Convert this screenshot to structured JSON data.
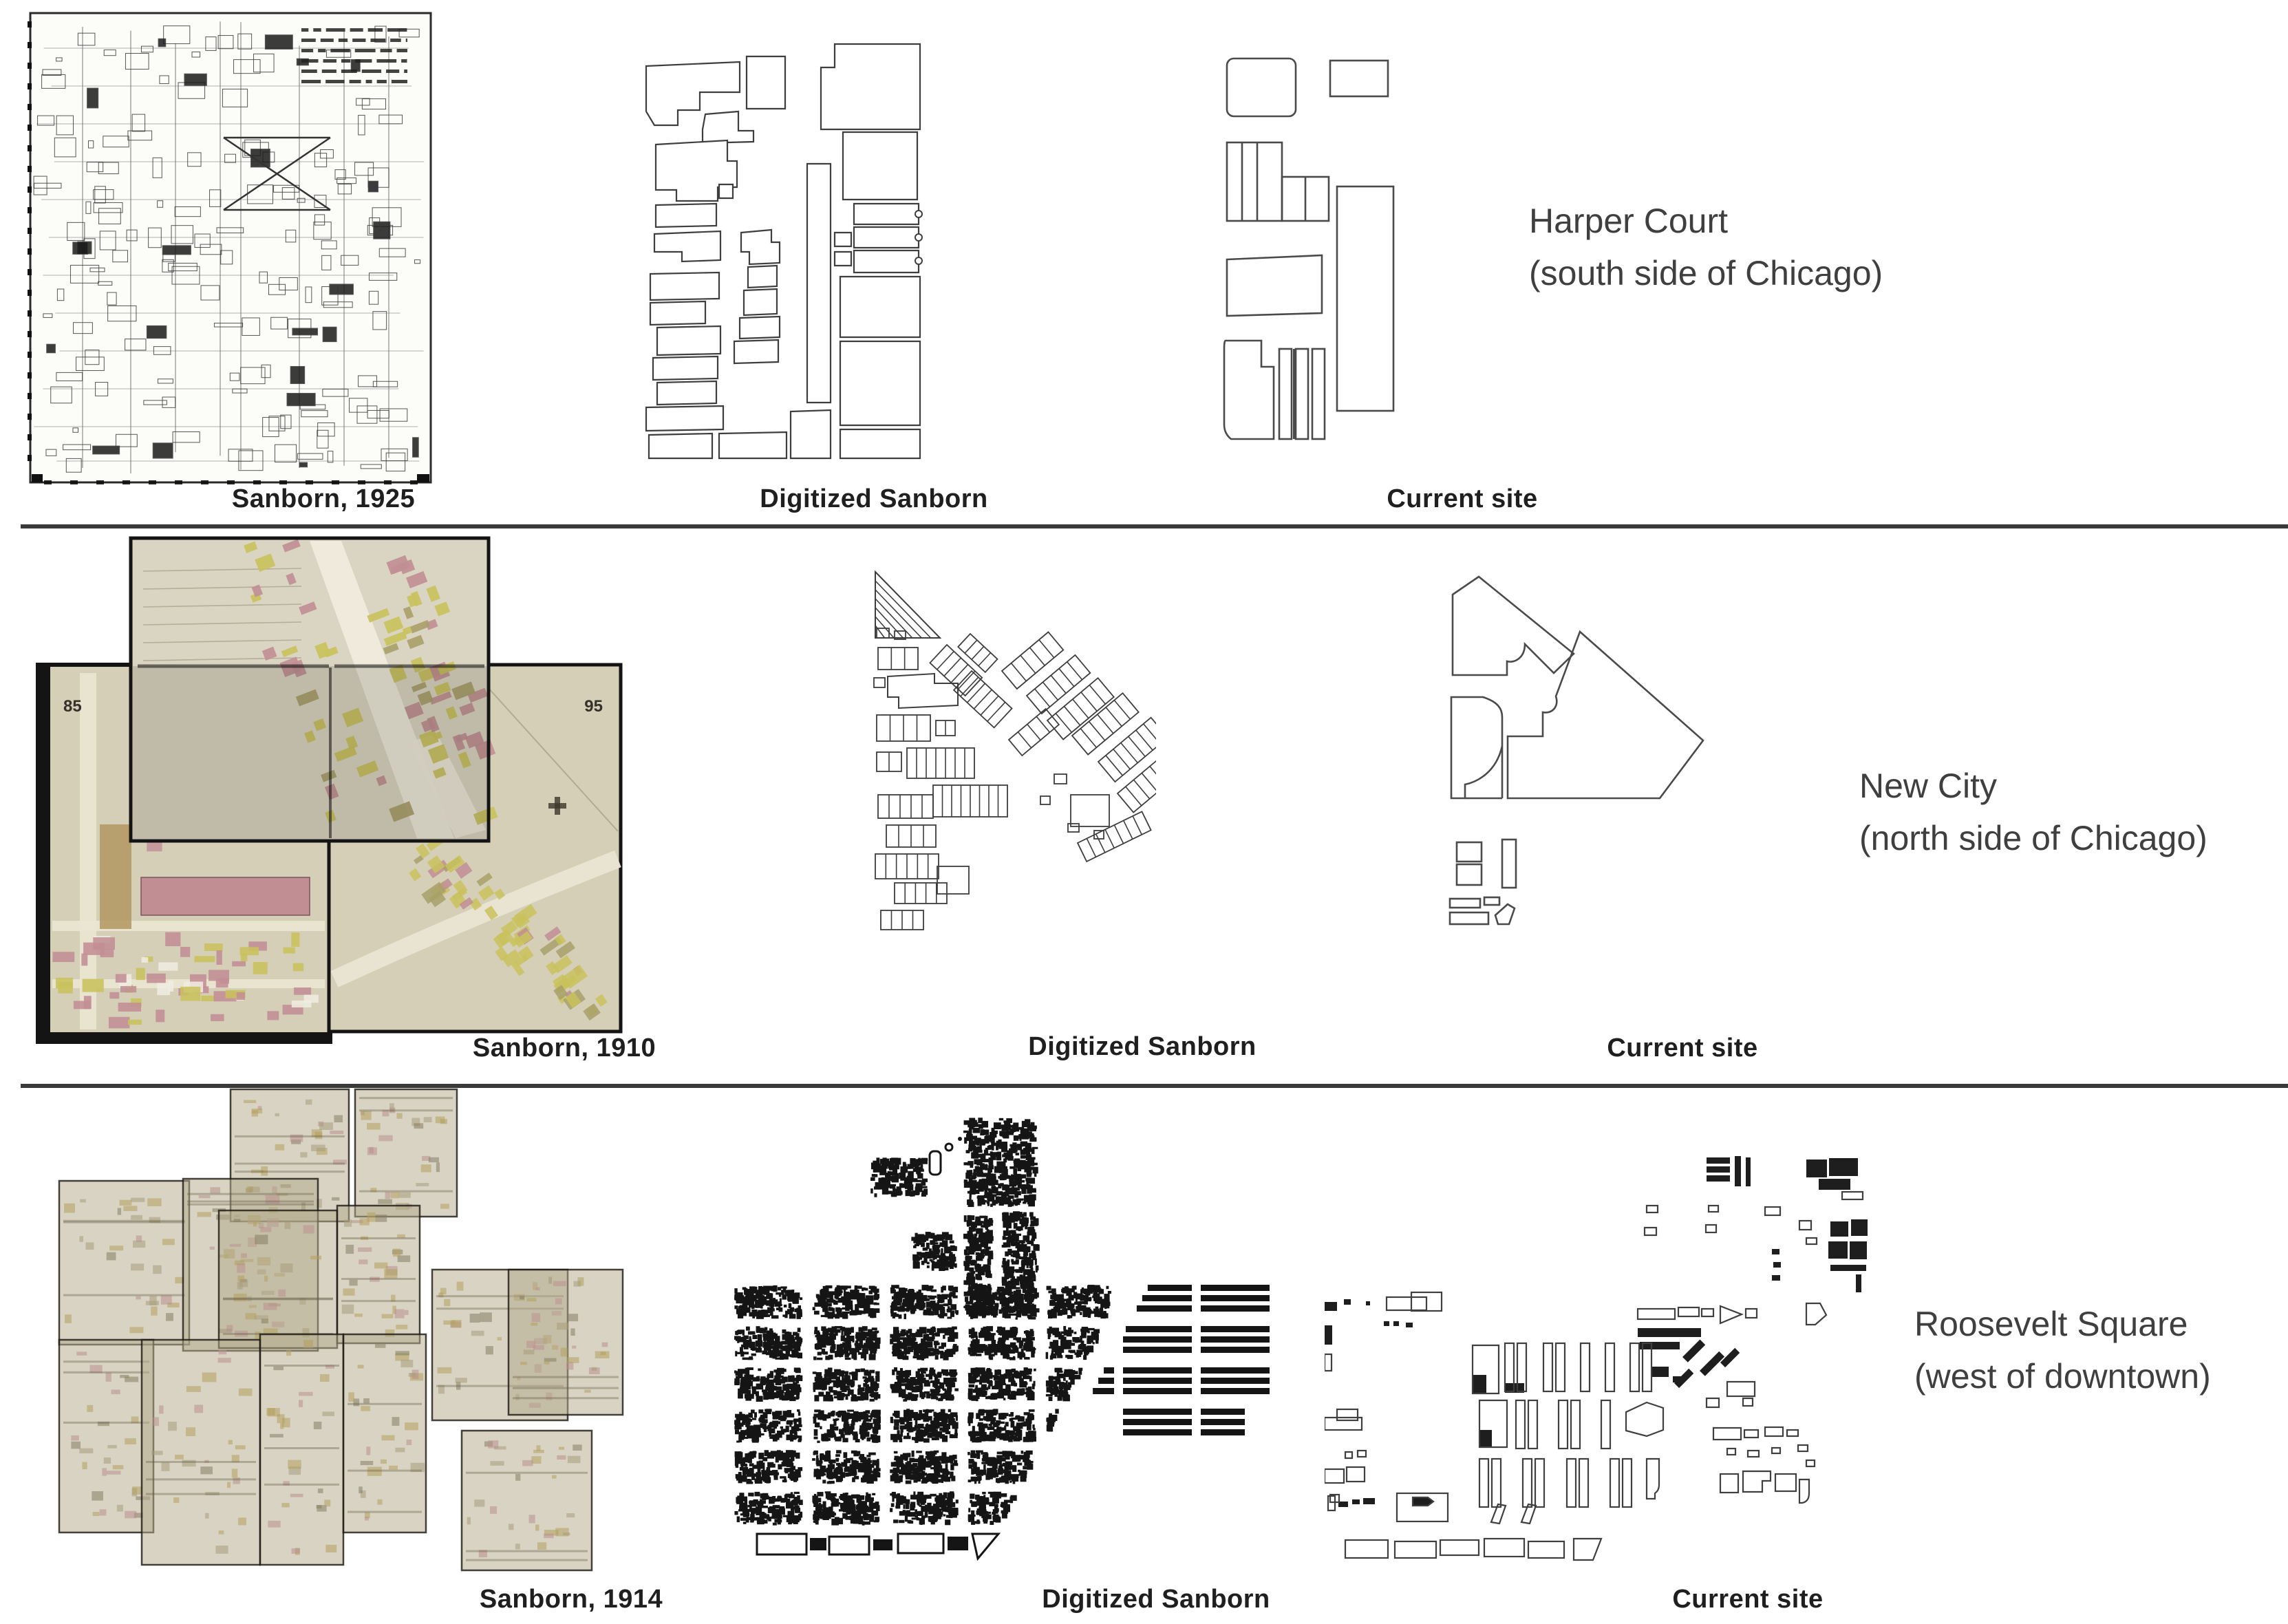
{
  "figure": {
    "type": "map-comparison-figure",
    "rows": [
      {
        "id": "harper-court",
        "panels": [
          {
            "caption": "Sanborn, 1925"
          },
          {
            "caption": "Digitized Sanborn"
          },
          {
            "caption": "Current site"
          }
        ],
        "label": {
          "title": "Harper Court",
          "subtitle": "(south side of Chicago)"
        }
      },
      {
        "id": "new-city",
        "panels": [
          {
            "caption": "Sanborn, 1910"
          },
          {
            "caption": "Digitized Sanborn"
          },
          {
            "caption": "Current site"
          }
        ],
        "label": {
          "title": "New City",
          "subtitle": "(north side of Chicago)"
        },
        "sheet_numbers": [
          "85",
          "95"
        ]
      },
      {
        "id": "roosevelt-square",
        "panels": [
          {
            "caption": "Sanborn, 1914"
          },
          {
            "caption": "Digitized Sanborn"
          },
          {
            "caption": "Current site"
          }
        ],
        "label": {
          "title": "Roosevelt Square",
          "subtitle": "(west of downtown)"
        }
      }
    ],
    "palette": {
      "ink": "#2a2a2a",
      "caption_color": "#1f1f1f",
      "label_color": "#3f3f3f",
      "divider_color": "#3a3a3a",
      "sheet_beige": "#d5cfb8",
      "sheet_beige_light": "#dad5c2",
      "sheet_tan": "#b4ab8c",
      "building_pink": "#c18e94",
      "building_yellow": "#c9c25c",
      "building_olive": "#a8a06a",
      "outline_gray": "#3e3e3e",
      "fill_black": "#151515"
    }
  }
}
